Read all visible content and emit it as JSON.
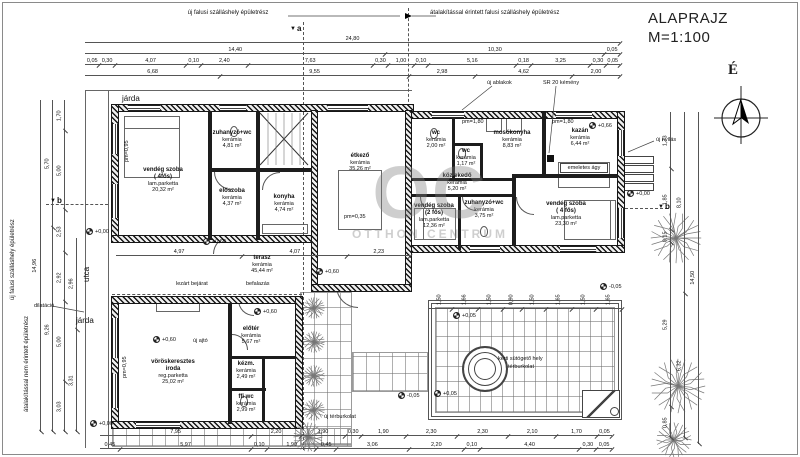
{
  "title": {
    "name": "ALAPRAJZ",
    "scale": "M=1:100"
  },
  "compass": {
    "north": "É"
  },
  "watermark": {
    "logo": "OC",
    "name": "OTTHON CENTRUM"
  },
  "top_notes": {
    "left": "új falusi szálláshely épületrész",
    "right": "átalakítással érintett falusi szálláshely épületrész"
  },
  "side_notes": [
    {
      "text": "új falusi szálláshely épületrész",
      "x": 10,
      "y": 300,
      "rot": -90
    },
    {
      "text": "átalakítással nem érintett épületrész",
      "x": 24,
      "y": 412,
      "rot": -90
    },
    {
      "text": "utca",
      "x": 82,
      "y": 282,
      "rot": -90,
      "big": true
    },
    {
      "text": "járda",
      "x": 122,
      "y": 94,
      "big": true
    },
    {
      "text": "járda",
      "x": 76,
      "y": 316,
      "big": true
    }
  ],
  "section_markers": [
    {
      "label": "a",
      "x": 290,
      "y": 24
    },
    {
      "label": "b",
      "x": 50,
      "y": 196
    },
    {
      "label": "b",
      "x": 658,
      "y": 202
    }
  ],
  "rooms": [
    {
      "name": "vendég szoba",
      "sub": "( 4fős)",
      "finish": "lam.parketta",
      "area": "20,32 m²",
      "x": 163,
      "y": 180
    },
    {
      "name": "zuhanyzó+wc",
      "finish": "kerámia",
      "area": "4,81 m²",
      "x": 232,
      "y": 140
    },
    {
      "name": "előszoba",
      "finish": "kerámia",
      "area": "4,37 m²",
      "x": 232,
      "y": 198
    },
    {
      "name": "konyha",
      "finish": "kerámia",
      "area": "4,74 m²",
      "x": 284,
      "y": 204
    },
    {
      "name": "étkező",
      "finish": "kerámia",
      "area": "35,26 m²",
      "x": 360,
      "y": 163
    },
    {
      "name": "wc",
      "finish": "kerámia",
      "area": "2,00 m²",
      "x": 436,
      "y": 140
    },
    {
      "name": "wc",
      "finish": "kerámia",
      "area": "1,17 m²",
      "x": 466,
      "y": 158
    },
    {
      "name": "közlekedő",
      "finish": "kerámia",
      "area": "5,20 m²",
      "x": 457,
      "y": 183
    },
    {
      "name": "mosókonyha",
      "finish": "kerámia",
      "area": "8,83 m²",
      "x": 512,
      "y": 140
    },
    {
      "name": "kazán",
      "finish": "kerámia",
      "area": "6,44 m²",
      "x": 580,
      "y": 138
    },
    {
      "name": "vendég szoba",
      "sub": "(2 fős)",
      "finish": "lam.parketta",
      "area": "12,36 m²",
      "x": 434,
      "y": 216
    },
    {
      "name": "zuhanyzó+wc",
      "finish": "kerámia",
      "area": "3,75 m²",
      "x": 484,
      "y": 210
    },
    {
      "name": "vendég szoba",
      "sub": "( 4 fős)",
      "finish": "lam.parketta",
      "area": "23,30 m²",
      "x": 566,
      "y": 214
    },
    {
      "name": "terasz",
      "finish": "kerámia",
      "area": "45,44 m²",
      "x": 262,
      "y": 265
    },
    {
      "name": "vöröskeresztes",
      "sub": "iroda",
      "finish": "reg.parketta",
      "area": "25,02 m²",
      "x": 173,
      "y": 372
    },
    {
      "name": "előtér",
      "finish": "kerámia",
      "area": "5,67 m²",
      "x": 251,
      "y": 336
    },
    {
      "name": "kézm.",
      "finish": "kerámia",
      "area": "2,49 m²",
      "x": 246,
      "y": 371
    },
    {
      "name": "ffi wc",
      "finish": "kerámia",
      "area": "2,99 m²",
      "x": 246,
      "y": 404
    }
  ],
  "annotations": [
    {
      "text": "új ablakok",
      "x": 487,
      "y": 80
    },
    {
      "text": "SR 20 kémény",
      "x": 543,
      "y": 80
    },
    {
      "text": "új nyílás",
      "x": 656,
      "y": 137
    },
    {
      "text": "lezárt bejárat",
      "x": 176,
      "y": 281
    },
    {
      "text": "befalazás",
      "x": 246,
      "y": 281
    },
    {
      "text": "új ajtó",
      "x": 193,
      "y": 338
    },
    {
      "text": "dilatáció",
      "x": 34,
      "y": 303
    },
    {
      "text": "emeletes ágy",
      "x": 560,
      "y": 163,
      "box": true,
      "w": 48
    },
    {
      "text": "kerti sütögető hely",
      "x": 498,
      "y": 356
    },
    {
      "text": "térburkolat",
      "x": 508,
      "y": 364
    },
    {
      "text": "új térburkolat",
      "x": 322,
      "y": 414,
      "wrap": true,
      "w": 36
    }
  ],
  "levels": [
    {
      "text": "+0,00",
      "x": 86,
      "y": 228
    },
    {
      "text": "+0,00",
      "x": 90,
      "y": 420
    },
    {
      "text": "+0,00",
      "x": 627,
      "y": 190
    },
    {
      "text": "+0,60",
      "x": 203,
      "y": 238
    },
    {
      "text": "+0,60",
      "x": 316,
      "y": 268
    },
    {
      "text": "+0,60",
      "x": 254,
      "y": 308
    },
    {
      "text": "+0,60",
      "x": 153,
      "y": 336
    },
    {
      "text": "+0,66",
      "x": 589,
      "y": 122
    },
    {
      "text": "-0,05",
      "x": 398,
      "y": 392
    },
    {
      "text": "-0,05",
      "x": 600,
      "y": 283
    },
    {
      "text": "+0,05",
      "x": 453,
      "y": 312
    },
    {
      "text": "+0,05",
      "x": 434,
      "y": 390
    }
  ],
  "pm_labels": [
    {
      "text": "pm=1,80",
      "x": 462,
      "y": 119
    },
    {
      "text": "pm=1,80",
      "x": 552,
      "y": 119
    },
    {
      "text": "pm=0,95",
      "x": 124,
      "y": 162,
      "rot": -90
    },
    {
      "text": "pm=0,95",
      "x": 122,
      "y": 378,
      "rot": -90
    },
    {
      "text": "pm=0,35",
      "x": 344,
      "y": 214
    }
  ],
  "dim_chains": [
    {
      "o": "h",
      "x": 85,
      "y": 34,
      "len": 535,
      "items": [
        "24,80"
      ]
    },
    {
      "o": "h",
      "x": 85,
      "y": 45,
      "len": 535,
      "items": [
        "14,40",
        "10,30",
        "0,05"
      ]
    },
    {
      "o": "h",
      "x": 85,
      "y": 56,
      "len": 535,
      "items": [
        "0,05",
        "0,30",
        "4,07",
        "0,10",
        "2,40",
        "7,63",
        "0,30",
        "1,00",
        "0,10",
        "5,16",
        "0,18",
        "3,25",
        "0,30",
        "0,05"
      ]
    },
    {
      "o": "h",
      "x": 85,
      "y": 67,
      "len": 535,
      "items": [
        "6,68",
        "9,55",
        "2,98",
        "4,62",
        "2,00"
      ]
    },
    {
      "o": "h",
      "x": 116,
      "y": 247,
      "len": 294,
      "items": [
        "4,97",
        "4,07",
        "2,23"
      ]
    },
    {
      "o": "h",
      "x": 428,
      "y": 300,
      "len": 194,
      "rott": true,
      "items": [
        "1,50",
        "1,66",
        "1,50",
        "0,90",
        "1,50",
        "1,65",
        "1,50",
        "1,65"
      ]
    },
    {
      "o": "h",
      "x": 100,
      "y": 427,
      "len": 512,
      "items": [
        "7,95",
        "2,20",
        "1,90",
        "0,30",
        "1,90",
        "2,30",
        "2,30",
        "2,10",
        "1,70",
        "0,05"
      ]
    },
    {
      "o": "h",
      "x": 100,
      "y": 440,
      "len": 512,
      "items": [
        "0,45",
        "5,97",
        "0,10",
        "1,90",
        "0,45",
        "3,06",
        "2,20",
        "0,10",
        "4,40",
        "0,30",
        "0,05"
      ]
    },
    {
      "o": "v",
      "x": 32,
      "y": 100,
      "len": 332,
      "items": [
        "14,96"
      ]
    },
    {
      "o": "v",
      "x": 44,
      "y": 100,
      "len": 332,
      "items": [
        "5,70",
        "9,26"
      ]
    },
    {
      "o": "v",
      "x": 56,
      "y": 100,
      "len": 332,
      "items": [
        "1,70",
        "5,00",
        "2,53",
        "2,92",
        "5,00",
        "3,03"
      ]
    },
    {
      "o": "v",
      "x": 68,
      "y": 238,
      "len": 194,
      "items": [
        "2,96",
        "3,31"
      ]
    },
    {
      "o": "v",
      "x": 662,
      "y": 112,
      "len": 326,
      "items": [
        "1,73",
        "1,85",
        "0,15",
        "5,29",
        "0,85"
      ]
    },
    {
      "o": "v",
      "x": 676,
      "y": 112,
      "len": 326,
      "items": [
        "8,10",
        "6,32"
      ]
    },
    {
      "o": "v",
      "x": 690,
      "y": 112,
      "len": 332,
      "items": [
        "14,50"
      ]
    }
  ]
}
